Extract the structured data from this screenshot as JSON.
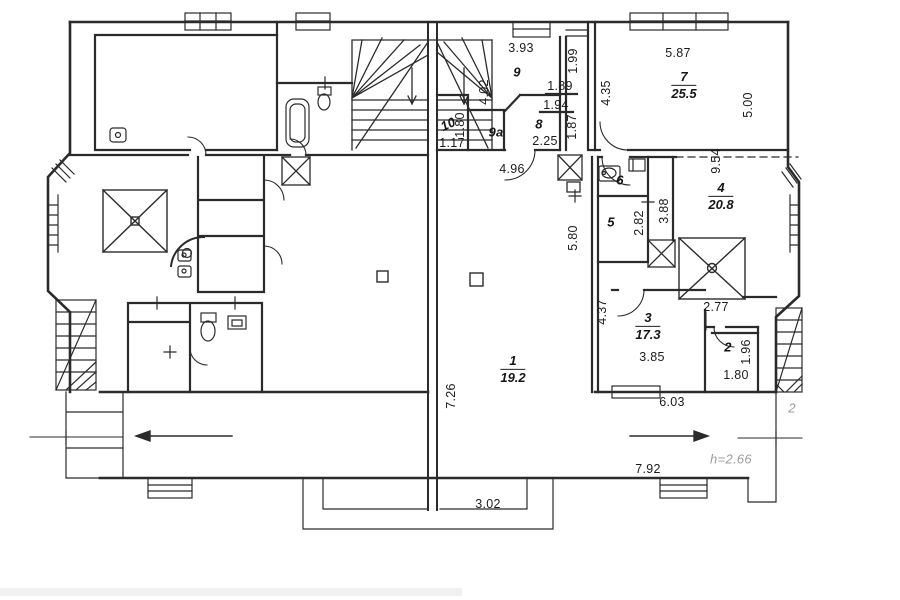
{
  "plan": {
    "rooms": [
      {
        "number": "1",
        "area": "19.2",
        "x": 513,
        "y": 369
      },
      {
        "number": "3",
        "area": "17.3",
        "x": 648,
        "y": 326
      },
      {
        "number": "4",
        "area": "20.8",
        "x": 721,
        "y": 196
      },
      {
        "number": "7",
        "area": "25.5",
        "x": 684,
        "y": 85
      }
    ],
    "room_tags": [
      {
        "text": "2",
        "x": 728,
        "y": 347,
        "rot": 0
      },
      {
        "text": "5",
        "x": 611,
        "y": 222,
        "rot": 0
      },
      {
        "text": "6",
        "x": 620,
        "y": 180,
        "rot": 0
      },
      {
        "text": "8",
        "x": 539,
        "y": 124,
        "rot": 0
      },
      {
        "text": "9",
        "x": 517,
        "y": 72,
        "rot": 0
      },
      {
        "text": "9a",
        "x": 496,
        "y": 132,
        "rot": 0
      },
      {
        "text": "10",
        "x": 448,
        "y": 124,
        "rot": -25
      }
    ],
    "dimensions": [
      {
        "text": "3.93",
        "x": 521,
        "y": 48,
        "rot": 0
      },
      {
        "text": "1.99",
        "x": 573,
        "y": 61,
        "rot": -90
      },
      {
        "text": "4.02",
        "x": 484,
        "y": 92,
        "rot": -90
      },
      {
        "text": "1.89",
        "x": 560,
        "y": 86,
        "rot": 0
      },
      {
        "text": "1.94",
        "x": 556,
        "y": 105,
        "rot": 0
      },
      {
        "text": "1.87",
        "x": 572,
        "y": 127,
        "rot": -90
      },
      {
        "text": "2.25",
        "x": 545,
        "y": 141,
        "rot": 0
      },
      {
        "text": "4.35",
        "x": 606,
        "y": 93,
        "rot": -90
      },
      {
        "text": "5.87",
        "x": 678,
        "y": 53,
        "rot": 0
      },
      {
        "text": "5.00",
        "x": 748,
        "y": 105,
        "rot": -90
      },
      {
        "text": "9.54",
        "x": 716,
        "y": 161,
        "rot": -90
      },
      {
        "text": "1.80",
        "x": 460,
        "y": 125,
        "rot": -90
      },
      {
        "text": "1.17",
        "x": 452,
        "y": 143,
        "rot": 0
      },
      {
        "text": "4.96",
        "x": 512,
        "y": 169,
        "rot": 0
      },
      {
        "text": "2.82",
        "x": 639,
        "y": 223,
        "rot": -90
      },
      {
        "text": "3.88",
        "x": 664,
        "y": 211,
        "rot": -90
      },
      {
        "text": "5.80",
        "x": 573,
        "y": 238,
        "rot": -90
      },
      {
        "text": "4.37",
        "x": 602,
        "y": 312,
        "rot": -90
      },
      {
        "text": "3.85",
        "x": 652,
        "y": 357,
        "rot": 0
      },
      {
        "text": "2.77",
        "x": 716,
        "y": 307,
        "rot": 0
      },
      {
        "text": "1.96",
        "x": 746,
        "y": 352,
        "rot": -90
      },
      {
        "text": "1.80",
        "x": 736,
        "y": 375,
        "rot": 0
      },
      {
        "text": "6.03",
        "x": 672,
        "y": 402,
        "rot": 0
      },
      {
        "text": "7.92",
        "x": 648,
        "y": 469,
        "rot": 0
      },
      {
        "text": "7.26",
        "x": 451,
        "y": 396,
        "rot": -90
      },
      {
        "text": "3.02",
        "x": 488,
        "y": 504,
        "rot": 0
      }
    ],
    "annotations": [
      {
        "text": "h=2.66",
        "x": 731,
        "y": 459,
        "rot": 0
      },
      {
        "text": "2",
        "x": 792,
        "y": 408,
        "rot": 0
      }
    ],
    "colors": {
      "line": "#2b2b2b",
      "label": "#1c1c1c",
      "muted": "#9c9c9c",
      "paper": "#ffffff"
    }
  }
}
